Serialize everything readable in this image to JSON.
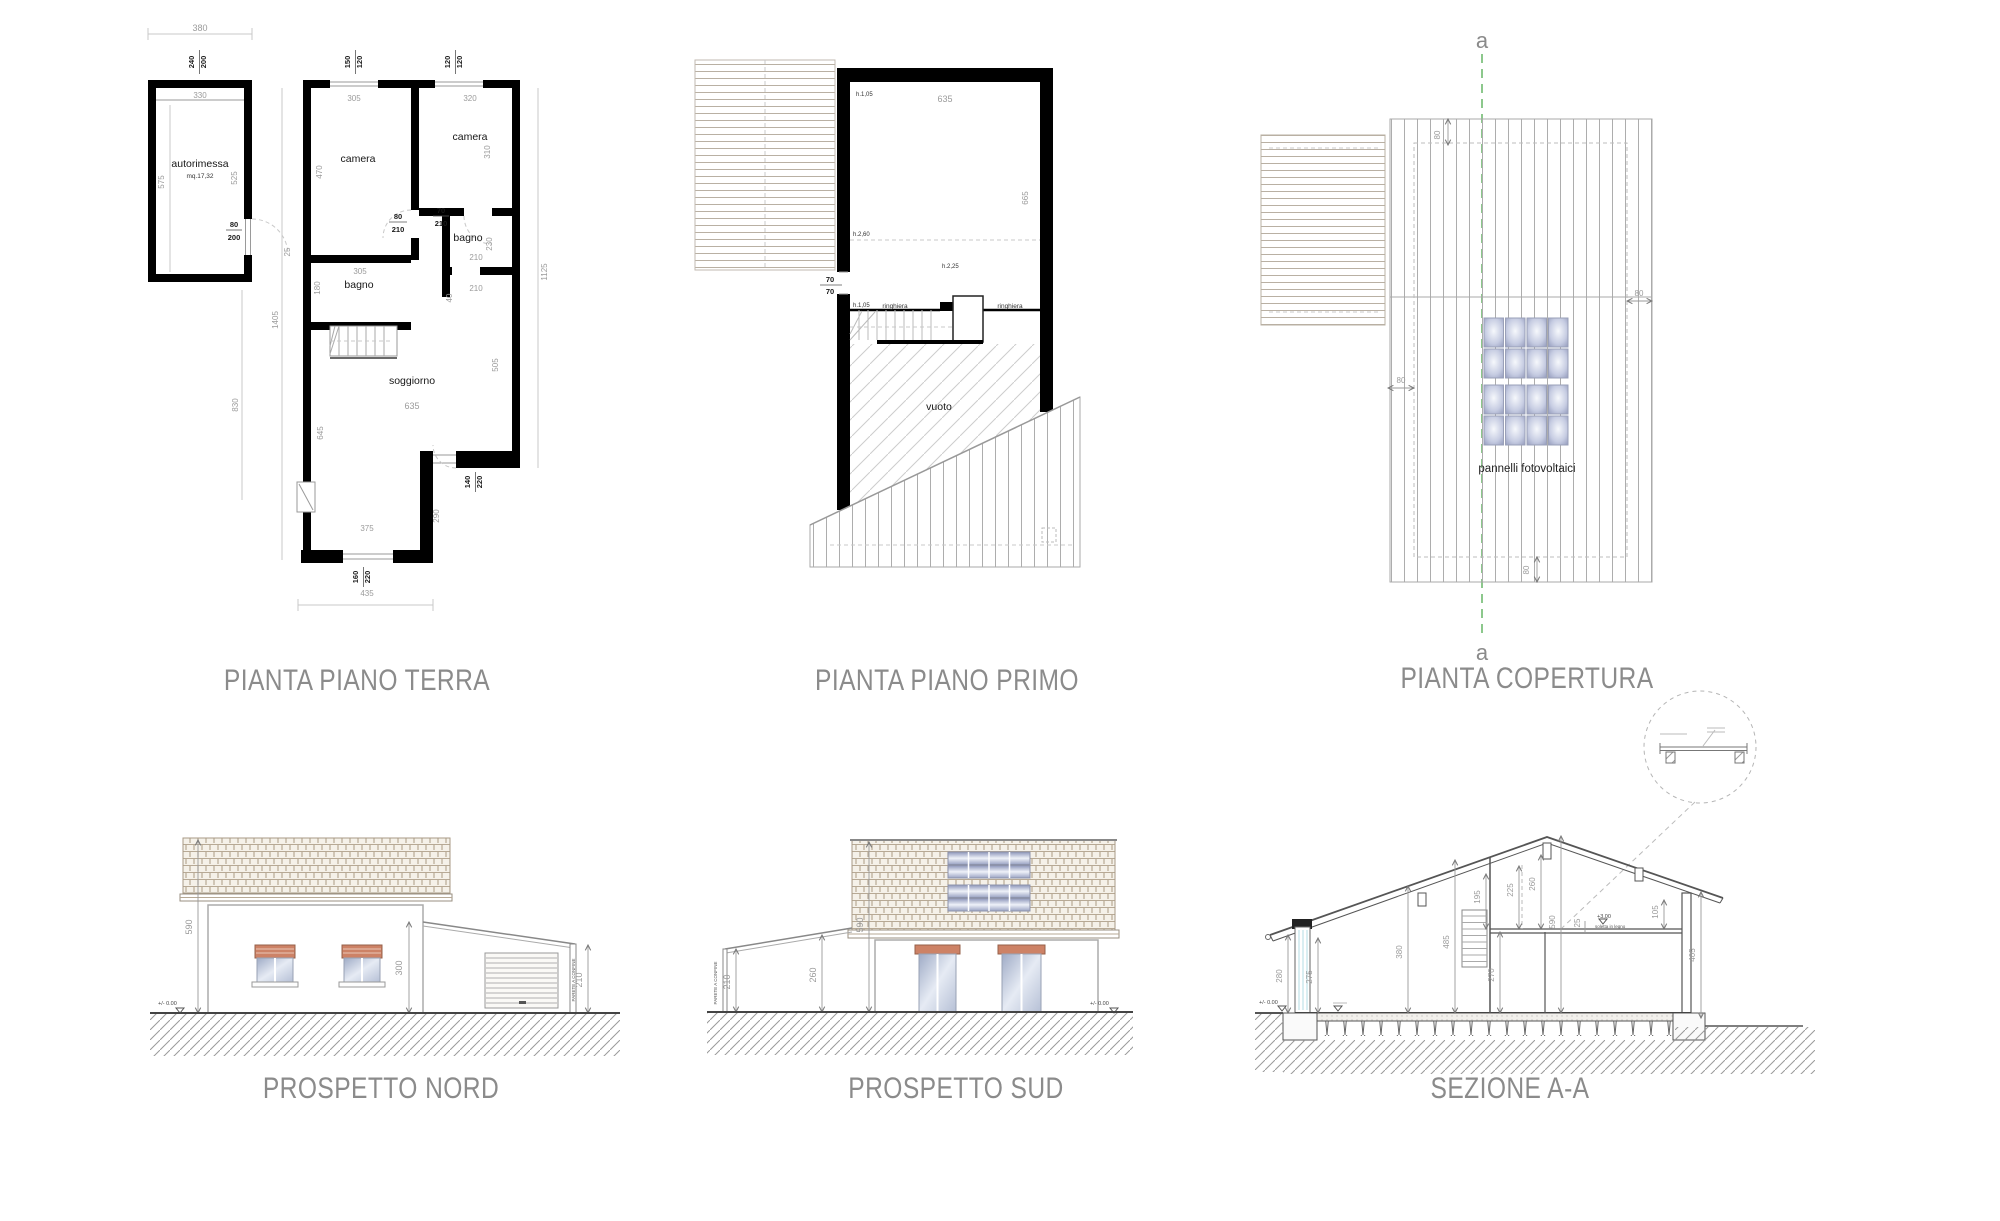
{
  "titles": {
    "pianta_terra": "PIANTA PIANO TERRA",
    "pianta_primo": "PIANTA PIANO PRIMO",
    "copertura": "PIANTA COPERTURA",
    "nord": "PROSPETTO NORD",
    "sud": "PROSPETTO SUD",
    "sezione": "SEZIONE A-A"
  },
  "p1": {
    "room_autorimessa": "autorimessa",
    "area_autorimessa": "mq.17,32",
    "room_camera1": "camera",
    "room_camera2": "camera",
    "room_bagno1": "bagno",
    "room_bagno2": "bagno",
    "room_soggiorno": "soggiorno",
    "d380": "380",
    "d240": "240",
    "d200": "200",
    "d330": "330",
    "d575": "575",
    "d525": "525",
    "d80door": "80",
    "d200door": "200",
    "d150": "150",
    "d120a": "120",
    "d120b": "120",
    "d120c": "120",
    "d305a": "305",
    "d320": "320",
    "d470": "470",
    "d310": "310",
    "d80b": "80",
    "d210a": "210",
    "d70": "70",
    "d210b": "210",
    "d230": "230",
    "d210c": "210",
    "d210d": "210",
    "d40": "40",
    "d305b": "305",
    "d180": "180",
    "d25": "25",
    "d1405": "1405",
    "d830": "830",
    "d635": "635",
    "d505": "505",
    "d645": "645",
    "d290": "290",
    "d140": "140",
    "d220a": "220",
    "d375": "375",
    "d160": "160",
    "d220b": "220",
    "d435": "435",
    "d1125": "1125"
  },
  "p2": {
    "d635": "635",
    "d665": "665",
    "h1": "h.1,05",
    "h2": "h.2,60",
    "h3": "h.2,25",
    "h4": "h.1,05",
    "d70a": "70",
    "d70b": "70",
    "ringhiera1": "ringhiera",
    "ringhiera2": "ringhiera",
    "vuoto": "vuoto"
  },
  "p3": {
    "sec_a_top": "a",
    "sec_a_bottom": "a",
    "d80top": "80",
    "d80right": "80",
    "d80left": "80",
    "d80bottom": "80",
    "pannelli": "pannelli fotovoltaici"
  },
  "p4": {
    "d590": "590",
    "d300": "300",
    "d210": "210",
    "lvl": "+/- 0.00",
    "parete": "PARETE A CONFINE"
  },
  "p5": {
    "d210": "210",
    "d260": "260",
    "d590": "590",
    "lvl": "+/- 0.00",
    "parete": "PARETE A CONFINE"
  },
  "p6": {
    "d280": "280",
    "d275": "275",
    "d380": "380",
    "d485": "485",
    "d270": "270",
    "d195": "195",
    "d225": "225",
    "d260": "260",
    "d590": "590",
    "d25": "25",
    "d105": "105",
    "d405": "405",
    "lvl0": "+/- 0.00",
    "lvl3": "+3,00",
    "soletta": "soletta in legno"
  },
  "colors": {
    "wall": "#000000",
    "dim_text": "#9b9b9b",
    "title_text": "#8b8b8b",
    "section_line": "#8cc88c",
    "terracotta": "#cd8266",
    "glass": "#b9c3d6",
    "roof_tile": "#b7a995",
    "solar_panel": "#8890b4"
  }
}
